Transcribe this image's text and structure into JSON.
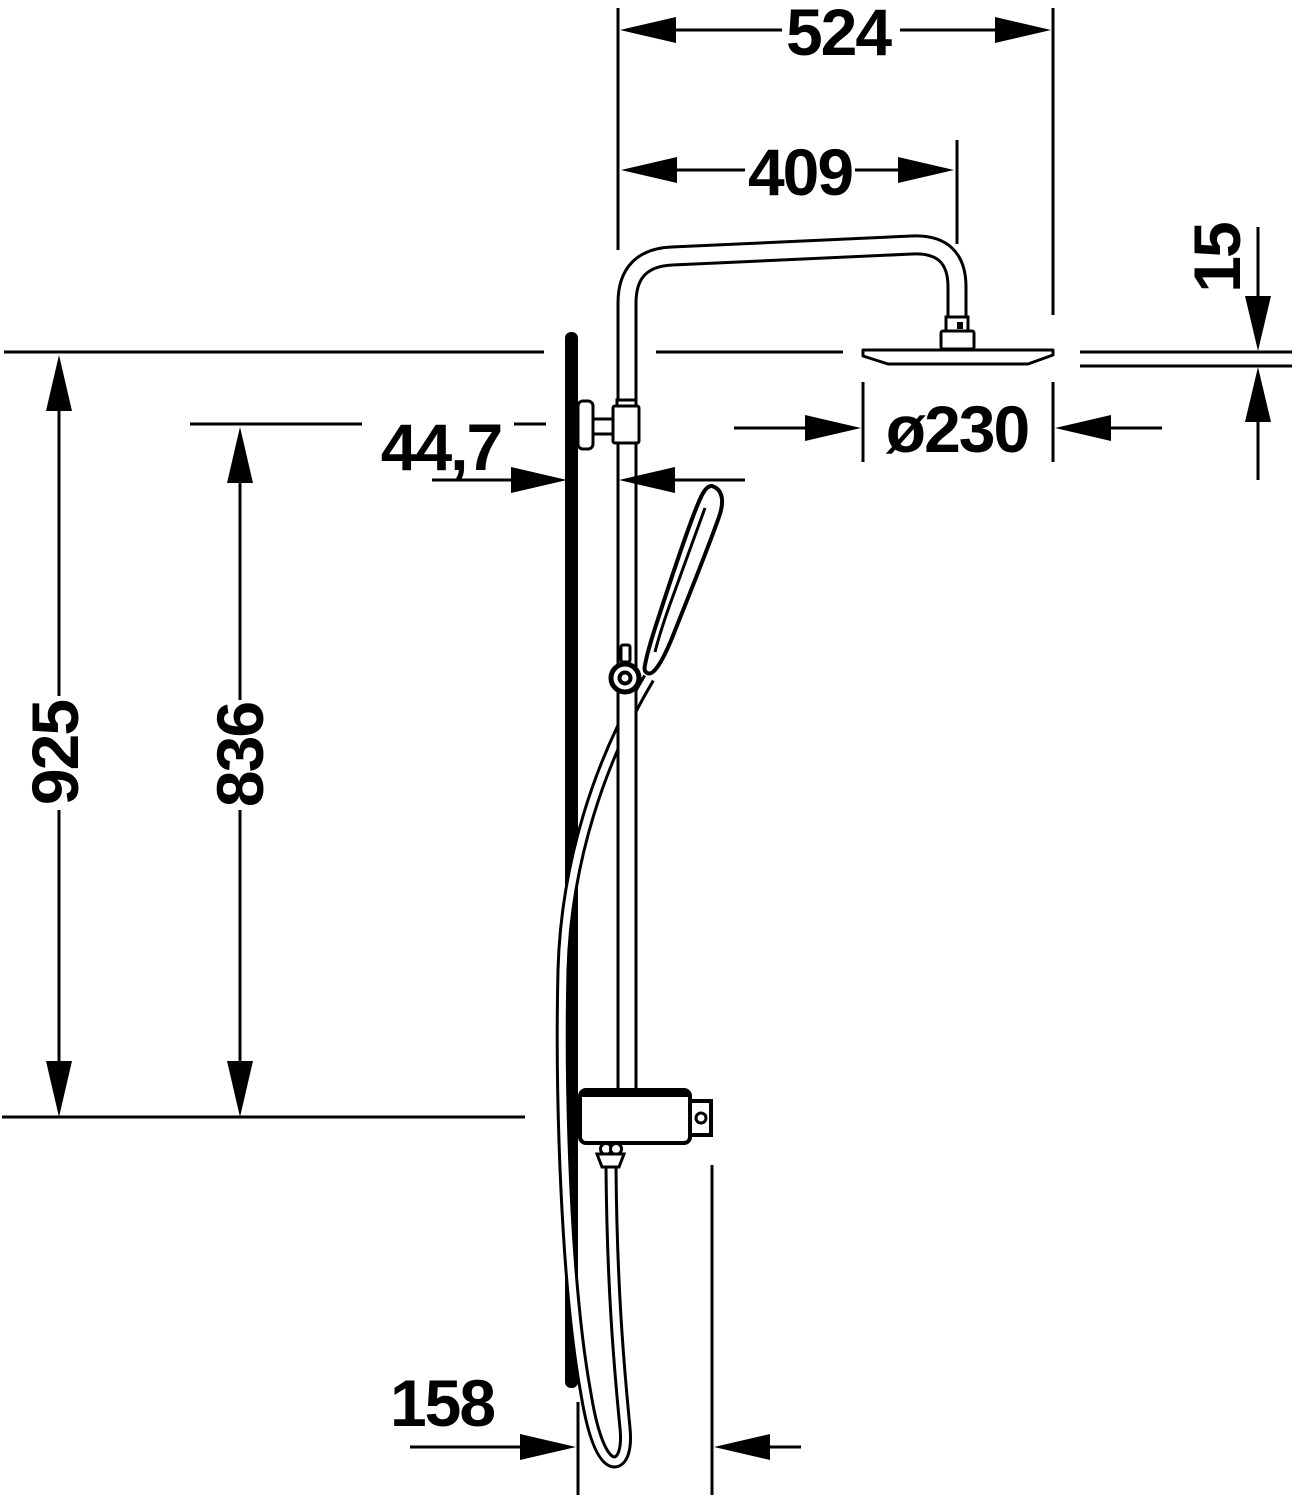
{
  "drawing": {
    "type": "technical-dimension-drawing",
    "subject": "shower-column-side-view",
    "colors": {
      "line": "#000000",
      "background": "#ffffff"
    },
    "dimensions": {
      "overall_width": "524",
      "arm_reach": "409",
      "head_thickness": "15",
      "head_diameter": "ø230",
      "pipe_wall_offset": "44,7",
      "overall_height": "925",
      "bracket_height": "836",
      "hose_wall_offset": "158"
    }
  }
}
